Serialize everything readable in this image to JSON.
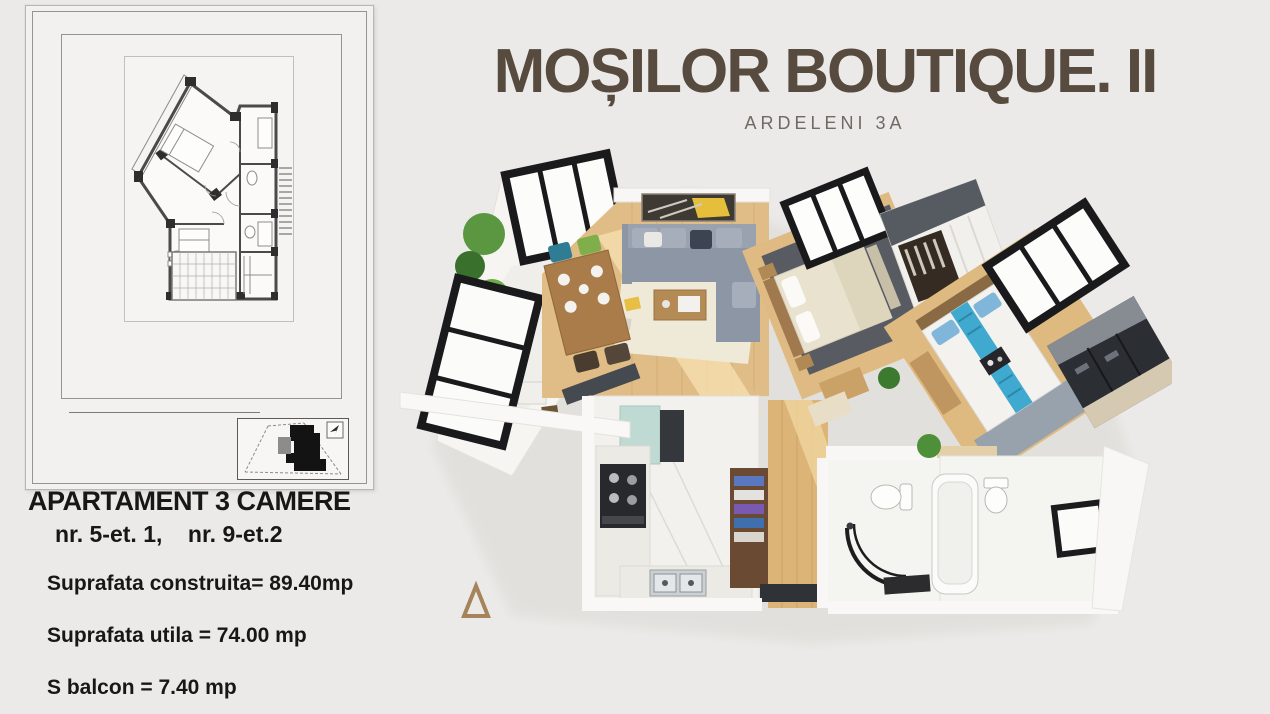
{
  "page": {
    "background_color": "#ebeae8"
  },
  "header": {
    "title": "MOȘILOR BOUTIQUE. II",
    "subtitle": "ARDELENI 3A",
    "title_color": "#574a3e",
    "subtitle_color": "#6f6a63"
  },
  "apartment_info": {
    "heading": "APARTAMENT 3 CAMERE",
    "units": "nr. 5-et. 1,    nr. 9-et.2",
    "areas": [
      "Suprafata construita= 89.40mp",
      "Suprafata utila = 74.00 mp",
      "S balcon = 7.40 mp"
    ]
  },
  "plan_sheet": {
    "content": "technical 2D floor plan drawing",
    "site_plan": "building site location map",
    "north_arrow": "north-arrow"
  },
  "render_3d": {
    "content": "3D isometric apartment render with living room, two bedrooms, kitchen, two bathrooms and balcony",
    "colors": {
      "wood_floor": "#deb97f",
      "wall_white": "#f8f7f5",
      "window_frame": "#1a1a1d",
      "sofa_gray": "#909aa8",
      "bed_runner_blue": "#44a8cd",
      "rug_dark": "#5b5e63",
      "kitchen_teal": "#bedad2",
      "plant_green": "#5a9740"
    }
  }
}
